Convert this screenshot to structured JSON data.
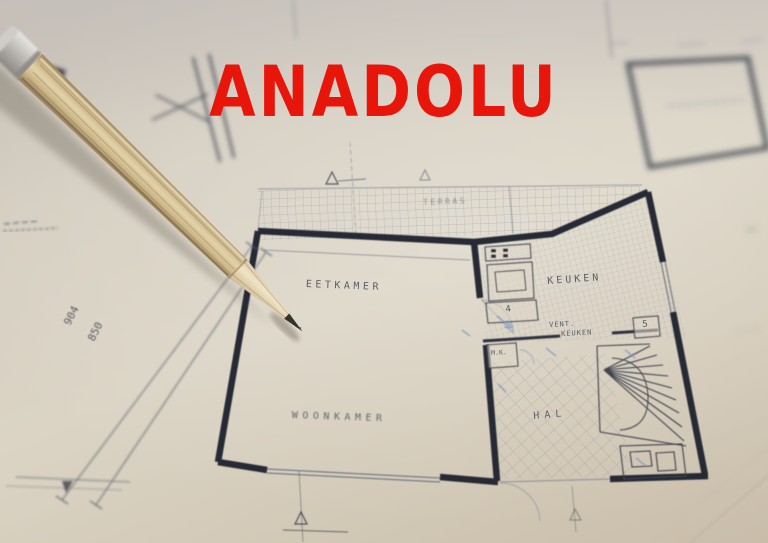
{
  "image": {
    "description": "Photograph: wooden pencil resting on an architectural floor plan drawing with red ANADOLU logo overlay",
    "width": 768,
    "height": 543
  },
  "logo": {
    "text": "ANADOLU",
    "color": "#e8150b"
  },
  "plan": {
    "room_labels": {
      "eetkamer": "EETKAMER",
      "woonkamer": "WOONKAMER",
      "keuken": "KEUKEN",
      "hal": "HAL",
      "terras": "TERRAS",
      "vent_line1": "VENT.",
      "vent_line2": "KEUKEN",
      "mk": "M.K."
    },
    "dimensions": {
      "dim1": "904",
      "dim2": "850"
    },
    "numbers": {
      "kitchen_counter": "4",
      "hall_box": "5"
    }
  },
  "colors": {
    "paper": "#d5cec1",
    "wall_ink": "#262a36",
    "thin_ink": "#707684",
    "blue_pencil": "#7c99c9",
    "pencil_wood": "#d3bd92",
    "logo_red": "#e8150b"
  }
}
